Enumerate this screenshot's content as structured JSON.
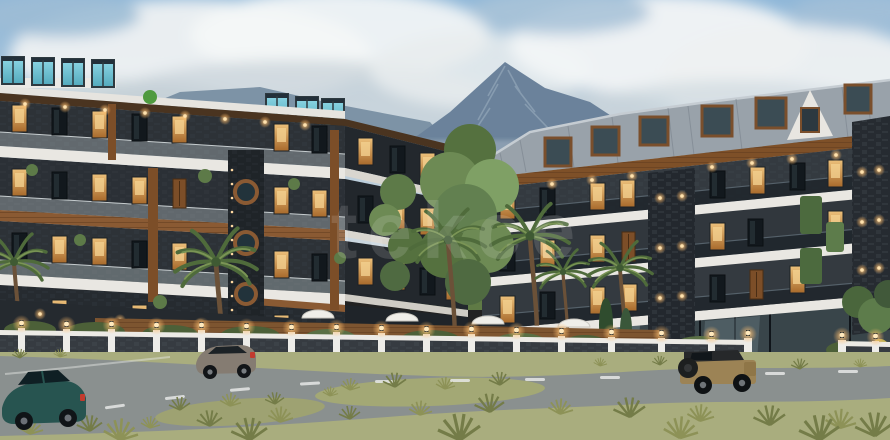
{
  "watermark": {
    "text": "tekce",
    "color": "#ffffff"
  },
  "scene": {
    "palette": {
      "sky": "#9fc0da",
      "cloud": "#eef1f2",
      "mountain": "#74889c",
      "building_light": "#e9e7e2",
      "building_dark": "#2d3237",
      "wood": "#7d4f2a",
      "rooftop_glass": "#6ec3d4",
      "mansard_roof": "#99a2aa",
      "grass": "#a9ad7e",
      "road": "#8a908f",
      "wall_stone": "#363b41",
      "lamp_glow": "#ffc278",
      "suv_teal": "#275450",
      "suv_gray": "#857c72",
      "jeep_tan": "#9c8355"
    }
  }
}
